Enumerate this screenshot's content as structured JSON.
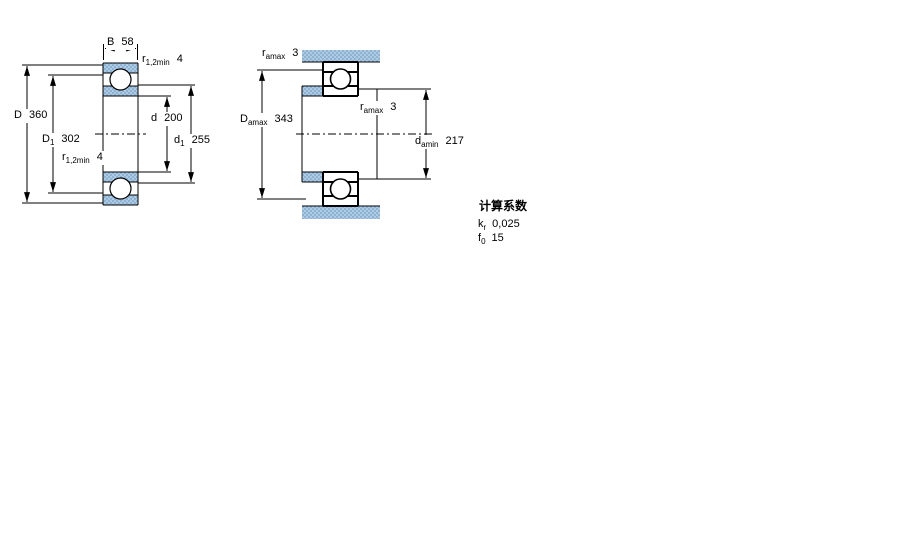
{
  "figure1": {
    "name": "bearing-cross-section",
    "dims": {
      "B": {
        "sym": "B",
        "sub": "",
        "val": "58"
      },
      "r12_top": {
        "sym": "r",
        "sub": "1,2min",
        "val": "4"
      },
      "D": {
        "sym": "D",
        "sub": "",
        "val": "360"
      },
      "D1": {
        "sym": "D",
        "sub": "1",
        "val": "302"
      },
      "r12_bot": {
        "sym": "r",
        "sub": "1,2min",
        "val": "4"
      },
      "d": {
        "sym": "d",
        "sub": "",
        "val": "200"
      },
      "d1": {
        "sym": "d",
        "sub": "1",
        "val": "255"
      }
    }
  },
  "figure2": {
    "name": "abutment-mounting-dimensions",
    "dims": {
      "r_amax_top": {
        "sym": "r",
        "sub": "amax",
        "val": "3"
      },
      "D_amax": {
        "sym": "D",
        "sub": "amax",
        "val": "343"
      },
      "r_amax_mid": {
        "sym": "r",
        "sub": "amax",
        "val": "3"
      },
      "d_amin": {
        "sym": "d",
        "sub": "amin",
        "val": "217"
      }
    }
  },
  "calculation_factors": {
    "title": "计算系数",
    "rows": [
      {
        "sym": "k",
        "sub": "r",
        "val": "0,025"
      },
      {
        "sym": "f",
        "sub": "0",
        "val": "15"
      }
    ]
  },
  "colors": {
    "hatch_light": "#aecbe6",
    "hatch_dark": "#8fb2d2",
    "line": "#000000",
    "background": "#ffffff"
  }
}
